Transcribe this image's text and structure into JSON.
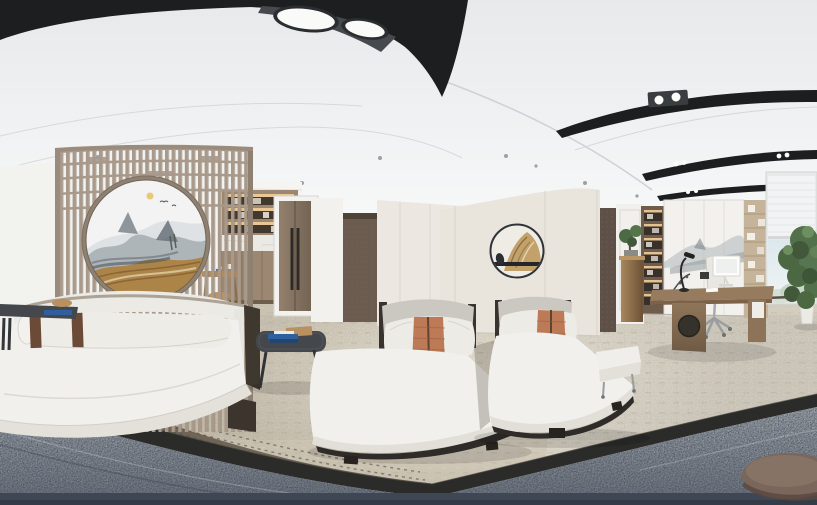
{
  "scene": {
    "kind": "360-degree equirectangular interior panorama",
    "room": "Modern Chinese-style wellness massage suite with executive office area",
    "image_width_px": 817,
    "image_height_px": 505
  },
  "colors": {
    "ceiling_band_black": "#1c1e20",
    "light_panel_gray": "#46494d",
    "lamp_white": "#fafaf8",
    "wall_white": "#f2f2ef",
    "wall_cream": "#e9e5dd",
    "screen_wood": "#a8998a",
    "painting_gold": "#ad8448",
    "painting_ink": "#7c858c",
    "pantry_wood": "#9c8872",
    "pantry_glow": "#e9c795",
    "door_wood": "#8a7765",
    "dark_panel_wood": "#6b5c4f",
    "art_gold": "#c2a26a",
    "office_wallpaper": "#5e5047",
    "mural_white": "#f3f1ed",
    "shelf_light_wood": "#c5b49a",
    "desk_wood": "#977b5e",
    "chair_white": "#e9e7e2",
    "window_sky": "#dfe9ed",
    "plant_green": "#52704a",
    "carpet_beige": "#c8c0af",
    "carpet_right": "#d3cdc0",
    "carpet_dark_brown": "#6f6455",
    "floor_border_dark": "#2b2b29",
    "floor_bluegray": "#8d96a2",
    "floor_bottom_band": "#3f4754",
    "mattress_white": "#f1f0ec",
    "backrest_gray": "#cbc7c1",
    "pillow_white": "#edebe6",
    "pillow_stripe": "#bd7a57",
    "bolster_stripe": "#6b4a38",
    "table_dark": "#44484c",
    "book_blue": "#2f5f9e",
    "tray_tan": "#b9905f",
    "pouf_brown": "#7a665a"
  },
  "objects": [
    {
      "name": "ceiling-light-fixture",
      "label": "Black curved ceiling fixture with twin round downlights"
    },
    {
      "name": "ceiling-light-arcs",
      "label": "Three black arc light tracks with paired spotlights"
    },
    {
      "name": "recessed-downlights",
      "label": "Small recessed ceiling downlights"
    },
    {
      "name": "lattice-screen",
      "label": "Wooden lattice partition screen with circular moon gate"
    },
    {
      "name": "moon-gate-painting",
      "label": "Circular ink-wash mountain landscape painting with gold rock"
    },
    {
      "name": "daybed",
      "label": "White upholstered curved platform daybed"
    },
    {
      "name": "bolster-pillow",
      "label": "White bolster pillow with brown leather straps"
    },
    {
      "name": "side-table",
      "label": "Dark cantilever side table with blue book and bowl"
    },
    {
      "name": "coffee-table",
      "label": "Dark rounded coffee table with blue books and tan tray"
    },
    {
      "name": "massage-lounger-left",
      "label": "White massage lounger with terracotta striped pillow"
    },
    {
      "name": "massage-lounger-right",
      "label": "White massage lounger with terracotta striped pillow"
    },
    {
      "name": "pantry-shelves",
      "label": "Back-lit pantry shelving with marble counter and cabinets"
    },
    {
      "name": "tea-table",
      "label": "Small wooden tea table with cups and stool"
    },
    {
      "name": "double-door",
      "label": "Tall wooden double door with long vertical handles"
    },
    {
      "name": "slatted-wall-panel",
      "label": "Dark textured wood wall panel"
    },
    {
      "name": "wall-art-circle",
      "label": "Round wall artwork with gold mountain and black bar"
    },
    {
      "name": "office-wallpaper",
      "label": "Dark patterned wallpaper strip"
    },
    {
      "name": "bronze-pedestal",
      "label": "Bronze pedestal cabinet with bonsai"
    },
    {
      "name": "office-shelves",
      "label": "Illuminated display shelving columns"
    },
    {
      "name": "office-mural",
      "label": "Ink-wash mountain mural behind the desk"
    },
    {
      "name": "office-desk",
      "label": "Wooden executive desk with round speaker cabinet"
    },
    {
      "name": "desk-monitor",
      "label": "White desktop monitor"
    },
    {
      "name": "desk-lamp",
      "label": "Black task lamp"
    },
    {
      "name": "office-chair",
      "label": "White office chair on star base"
    },
    {
      "name": "window-blinds",
      "label": "Window with half-lowered roller blind"
    },
    {
      "name": "potted-plant",
      "label": "Tall green potted plant"
    },
    {
      "name": "white-bench",
      "label": "Small white bench"
    },
    {
      "name": "floor-pouf",
      "label": "Round grey-brown floor pouf"
    },
    {
      "name": "carpet",
      "label": "Beige carpet tiles with dark curved border"
    },
    {
      "name": "stone-floor",
      "label": "Blue-grey speckled stone floor ring at panorama bottom"
    }
  ]
}
